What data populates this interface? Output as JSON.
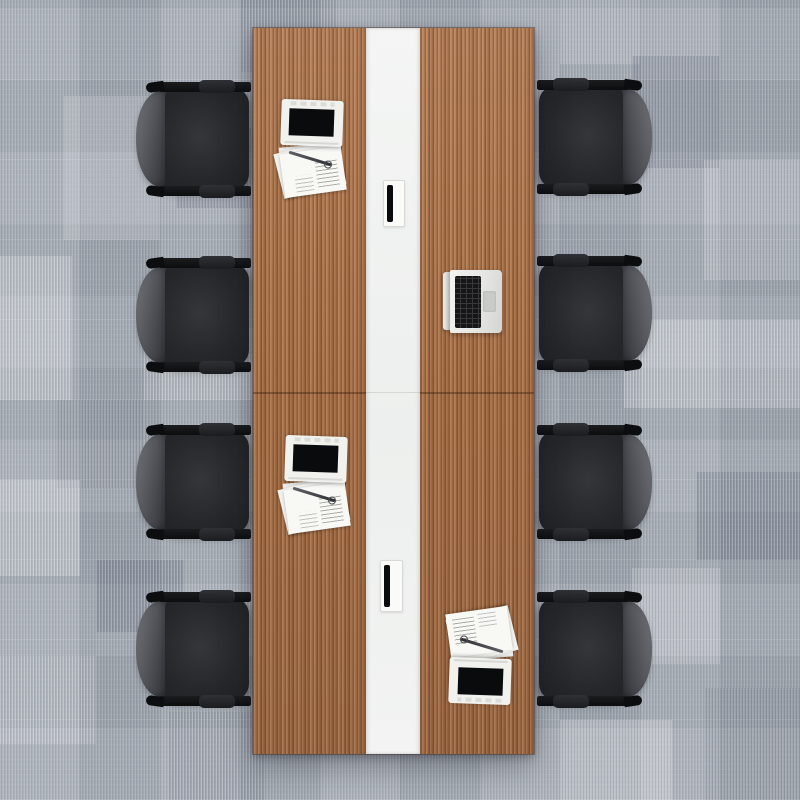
{
  "scene": {
    "title": "Top-down view of a conference meeting table with eight office chairs on carpet tiles",
    "canvas": {
      "width": 800,
      "height": 800
    }
  },
  "palette": {
    "carpet_base": "#a6acb4",
    "wood": "#ad7349",
    "wood_dark": "#8f5c39",
    "wood_light": "#c08a5e",
    "stripe_white": "#f4f5f4",
    "chair_seat": "#26272b",
    "chair_back_light": "#73747a",
    "chair_back_dark": "#2e2f33",
    "chair_frame": "#0c0d0f",
    "laptop_white": "#f1f2ee",
    "laptop_silver": "#e6e7e5",
    "screen_black": "#0a0b0d",
    "keys_black": "#161618",
    "paper_white": "#f8f8f5"
  },
  "floor": {
    "tile_size": 80,
    "patches": [
      {
        "x": 64,
        "y": 96,
        "w": 96,
        "h": 144,
        "shade": "light"
      },
      {
        "x": 240,
        "y": 0,
        "w": 96,
        "h": 72,
        "shade": "dark"
      },
      {
        "x": 0,
        "y": 256,
        "w": 72,
        "h": 144,
        "shade": "bright"
      },
      {
        "x": 144,
        "y": 328,
        "w": 112,
        "h": 72,
        "shade": "light"
      },
      {
        "x": 56,
        "y": 400,
        "w": 88,
        "h": 88,
        "shade": "dark"
      },
      {
        "x": 0,
        "y": 480,
        "w": 80,
        "h": 96,
        "shade": "bright"
      },
      {
        "x": 96,
        "y": 560,
        "w": 88,
        "h": 72,
        "shade": "deep"
      },
      {
        "x": 0,
        "y": 656,
        "w": 96,
        "h": 88,
        "shade": "light"
      },
      {
        "x": 168,
        "y": 712,
        "w": 96,
        "h": 88,
        "shade": "dark"
      },
      {
        "x": 176,
        "y": 128,
        "w": 80,
        "h": 80,
        "shade": "deep"
      },
      {
        "x": 560,
        "y": 0,
        "w": 80,
        "h": 64,
        "shade": "light"
      },
      {
        "x": 632,
        "y": 56,
        "w": 88,
        "h": 112,
        "shade": "deep"
      },
      {
        "x": 704,
        "y": 160,
        "w": 96,
        "h": 120,
        "shade": "light"
      },
      {
        "x": 624,
        "y": 320,
        "w": 176,
        "h": 88,
        "shade": "bright"
      },
      {
        "x": 696,
        "y": 472,
        "w": 104,
        "h": 88,
        "shade": "deep"
      },
      {
        "x": 632,
        "y": 568,
        "w": 88,
        "h": 96,
        "shade": "light"
      },
      {
        "x": 560,
        "y": 720,
        "w": 112,
        "h": 80,
        "shade": "bright"
      },
      {
        "x": 704,
        "y": 688,
        "w": 96,
        "h": 112,
        "shade": "dark"
      }
    ]
  },
  "table": {
    "x": 253,
    "y": 28,
    "width": 281,
    "height": 726,
    "stripe": {
      "x": 113,
      "width": 54
    },
    "seam_y": 364,
    "grommets": [
      {
        "x": 130,
        "y": 152,
        "width": 20,
        "height": 45
      },
      {
        "x": 127,
        "y": 532,
        "width": 21,
        "height": 50
      }
    ]
  },
  "chairs": [
    {
      "side": "left",
      "x": 134,
      "y": 82
    },
    {
      "side": "left",
      "x": 134,
      "y": 258
    },
    {
      "side": "left",
      "x": 134,
      "y": 425
    },
    {
      "side": "left",
      "x": 134,
      "y": 592
    },
    {
      "side": "right",
      "x": 534,
      "y": 80
    },
    {
      "side": "right",
      "x": 534,
      "y": 256
    },
    {
      "side": "right",
      "x": 534,
      "y": 425
    },
    {
      "side": "right",
      "x": 534,
      "y": 592
    }
  ],
  "items": [
    {
      "type": "laptop-with-papers",
      "x": 278,
      "y": 100,
      "flip": false
    },
    {
      "type": "open-laptop",
      "x": 443,
      "y": 270,
      "flip": false
    },
    {
      "type": "laptop-with-papers",
      "x": 282,
      "y": 436,
      "flip": false
    },
    {
      "type": "laptop-with-papers",
      "x": 444,
      "y": 606,
      "flip": true
    }
  ]
}
